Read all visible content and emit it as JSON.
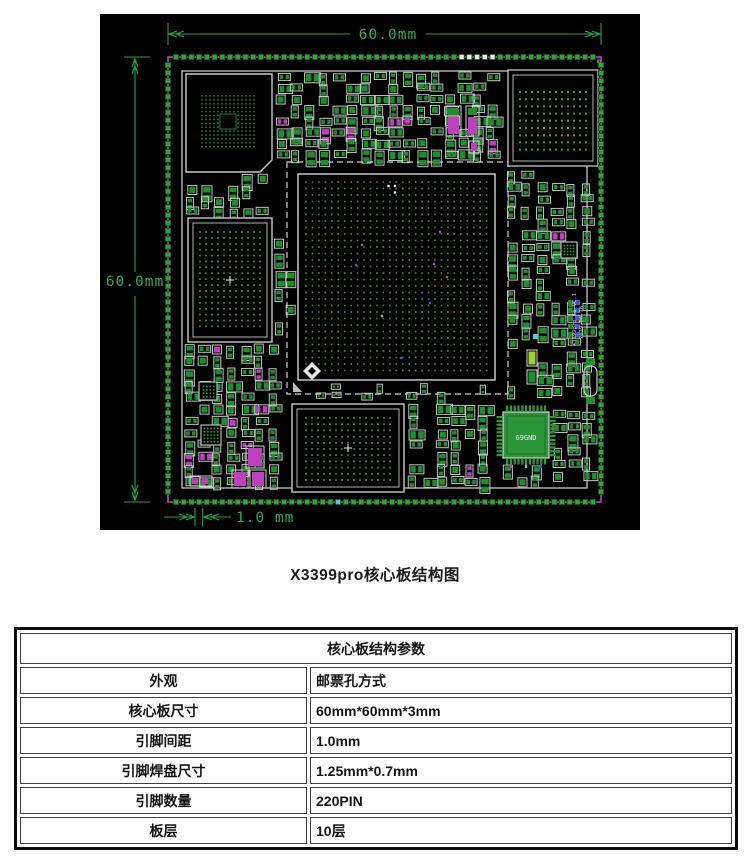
{
  "figure": {
    "caption": "X3399pro核心板结构图",
    "dim_top": "60.0mm",
    "dim_left": "60.0mm",
    "dim_pitch": "1.0 mm",
    "qfp_label": "69GND",
    "silk_line1": "X3399pro Ca-V1.1",
    "silk_line2": "2019-06-18",
    "corner_mark": "m",
    "colors": {
      "board_bg": "#000000",
      "pad_green": "#34a436",
      "pad_edge": "#0b4a10",
      "comp_green": "#1f8f2e",
      "dot_green": "#1fa241",
      "outline_gray": "#c7c7c7",
      "magenta": "#bf3fbf",
      "dim_green": "#1ea24f",
      "blue": "#3b59d6",
      "cyan": "#45cfe6",
      "lime": "#9cd32e",
      "white": "#e9e9e9"
    },
    "pins_per_side": 55
  },
  "table": {
    "title": "核心板结构参数",
    "rows": [
      {
        "label": "外观",
        "value": "邮票孔方式"
      },
      {
        "label": "核心板尺寸",
        "value": "60mm*60mm*3mm"
      },
      {
        "label": "引脚间距",
        "value": "1.0mm"
      },
      {
        "label": "引脚焊盘尺寸",
        "value": "1.25mm*0.7mm"
      },
      {
        "label": "引脚数量",
        "value": "220PIN"
      },
      {
        "label": "板层",
        "value": "10层"
      }
    ]
  }
}
